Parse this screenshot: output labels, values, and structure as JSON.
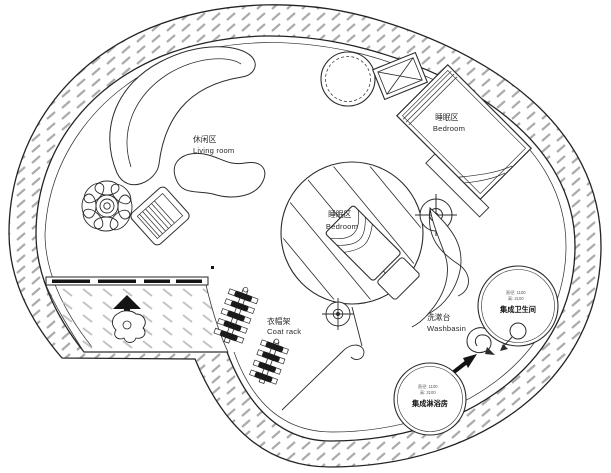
{
  "drawing": {
    "type": "circular floor plan",
    "colors": {
      "line": "#2b2b2b",
      "wall_hatch": "#ababab",
      "floor_hatch": "#c3c3c3",
      "solid_fill": "#141414",
      "background": "#ffffff"
    }
  },
  "labels": {
    "living_room": {
      "zh": "休闲区",
      "en": "Living room"
    },
    "bedroom_top": {
      "zh": "睡眠区",
      "en": "Bedroom"
    },
    "bedroom_center": {
      "zh": "睡眠区",
      "en": "Bedroom"
    },
    "coat_rack": {
      "zh": "衣帽架",
      "en": "Coat rack"
    },
    "washbasin": {
      "zh": "洗漱台",
      "en": "Washbasin"
    },
    "toilet_pod": {
      "dim1": "直径: 1100",
      "dim2": "高: 2100",
      "name": "集成卫生间"
    },
    "shower_pod": {
      "dim1": "直径: 1100",
      "dim2": "高: 2100",
      "name": "集成淋浴房"
    }
  }
}
